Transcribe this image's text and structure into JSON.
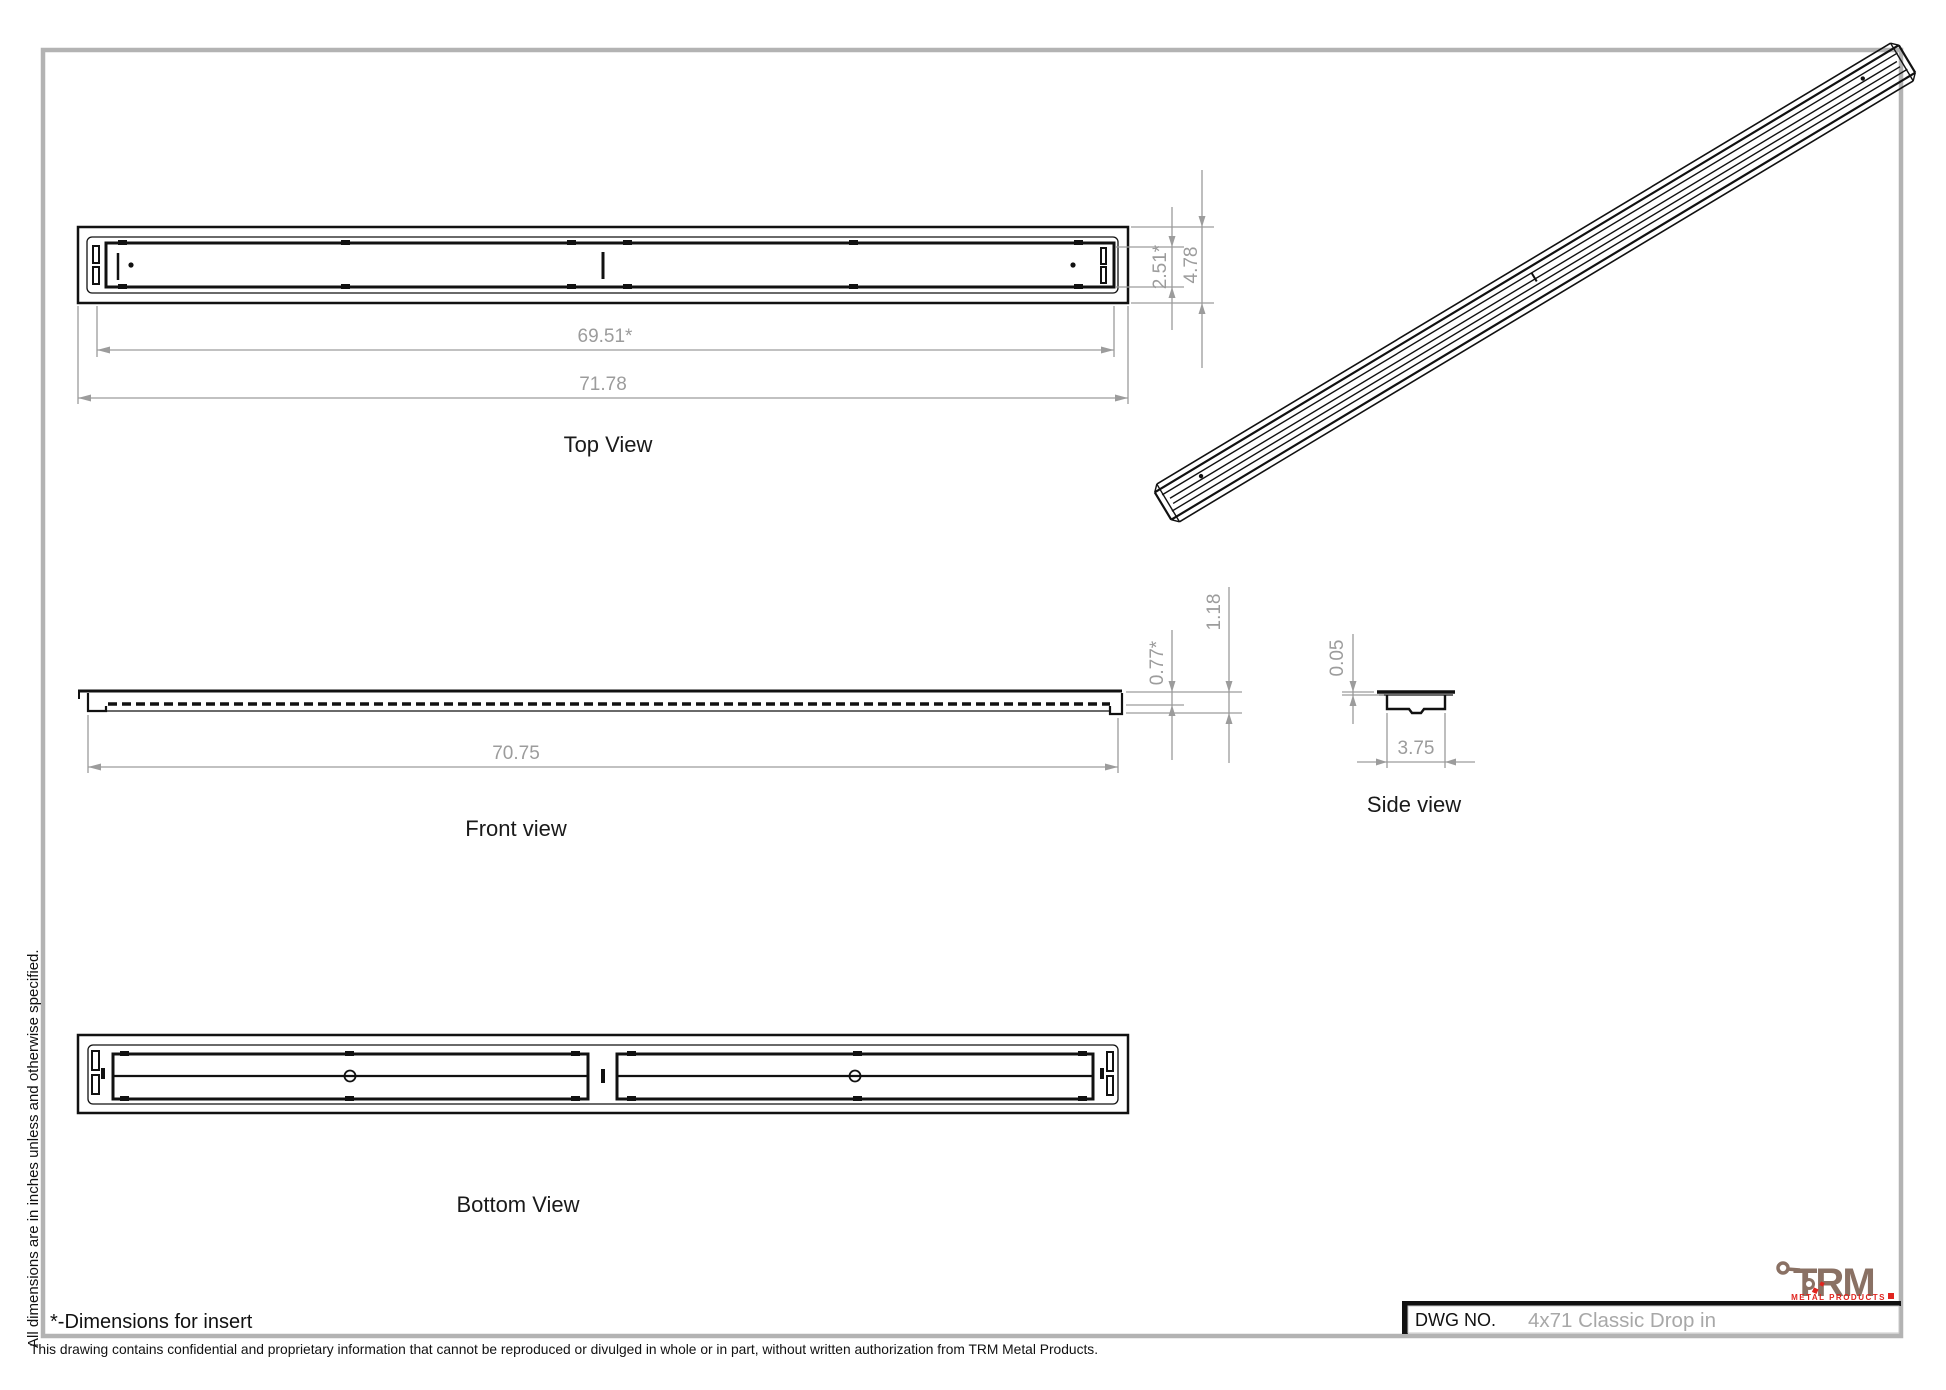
{
  "sheet": {
    "colors": {
      "line": "#111111",
      "dimension": "#9c9c9c",
      "border": "#b3b3b3",
      "logo_brown": "#8a7164",
      "logo_red": "#e0251f"
    }
  },
  "views": {
    "top_view": {
      "label": "Top View",
      "dim_insert_length": "69.51*",
      "dim_overall_length": "71.78",
      "dim_insert_width": "2.51*",
      "dim_overall_width": "4.78"
    },
    "front_view": {
      "label": "Front view",
      "dim_body_length": "70.75",
      "dim_insert_depth": "0.77*",
      "dim_overall_height": "1.18"
    },
    "side_view": {
      "label": "Side view",
      "dim_flange_thickness": "0.05",
      "dim_body_width": "3.75"
    },
    "bottom_view": {
      "label": "Bottom View"
    }
  },
  "notes": {
    "insert_note": "*-Dimensions for insert",
    "units_note": "All dimensions are in inches unless and otherwise specified.",
    "confidentiality": "This drawing contains confidential and proprietary information that cannot be reproduced or divulged in whole or in part, without written authorization from TRM Metal Products."
  },
  "title_block": {
    "dwg_no_label": "DWG NO.",
    "drawing_name": "4x71 Classic Drop in"
  },
  "logo": {
    "name": "TRM",
    "tagline": "METAL PRODUCTS"
  }
}
